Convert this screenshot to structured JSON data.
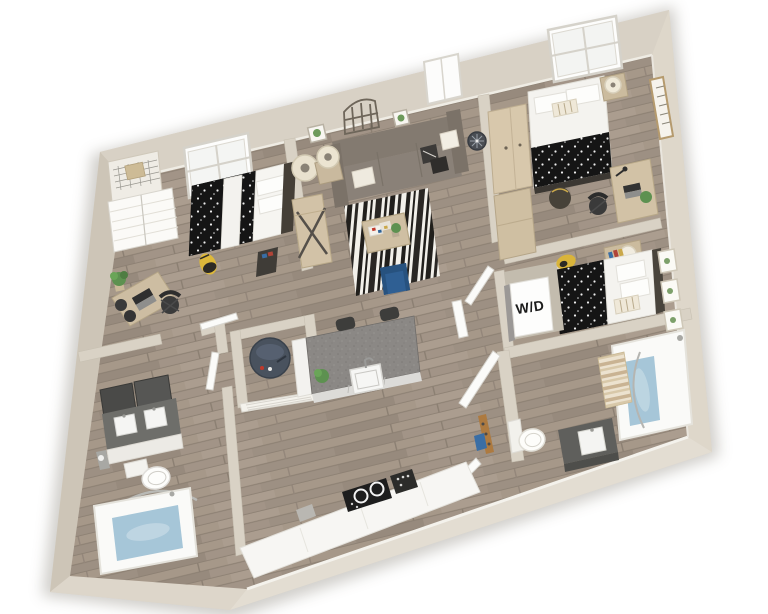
{
  "scene": {
    "kind": "3d-floor-plan-render",
    "view": "isometric top-down, plan rotated slightly counter-clockwise",
    "background": "#ffffff"
  },
  "labels": {
    "washer_dryer": "W/D"
  },
  "colors": {
    "wall": "#d8d1c5",
    "wall_left": "#cdc5b7",
    "wall_right": "#ded7ca",
    "wall_bottom_right": "#e3ddd2",
    "wall_bottom_left": "#ddd6ca",
    "floor_wood": "#a29487",
    "rug_base": "#f2f0ea",
    "rug_stripe": "#211f1c",
    "accent_chair": "#2f5f93",
    "tub_water": "#a6c6d8",
    "duvet_dots": "#151515",
    "sofa": "#8a8178",
    "island_top": "#8b8885",
    "vanity_dark": "#5f5f5c",
    "water_heater": "#49525e",
    "wood_furniture": "#d2c2a6",
    "plant": "#5d9150",
    "backpack": "#ddb83a",
    "counter_white": "#f7f6f3"
  },
  "rooms": [
    {
      "name": "Bedroom 1",
      "position": "top-left",
      "furniture": [
        "closet-shelf",
        "closet-door",
        "skylight-window",
        "polka-dot-bed",
        "nightstand",
        "desk",
        "office-chair",
        "backpack",
        "plant"
      ]
    },
    {
      "name": "Living Room",
      "position": "top-center",
      "furniture": [
        "sofa",
        "table-lamps",
        "side-table",
        "console-table",
        "striped-rug",
        "coffee-table",
        "accent-chair",
        "wall-clock",
        "arch-wall-decor",
        "framed-plants",
        "window"
      ]
    },
    {
      "name": "Bedroom 2",
      "position": "top-right",
      "furniture": [
        "skylight-window",
        "bed",
        "nightstand",
        "lamp",
        "wardrobe",
        "desk",
        "office-chair",
        "vertical-wall-sign",
        "backpack"
      ]
    },
    {
      "name": "Sleeping Nook",
      "position": "right-middle",
      "furniture": [
        "polka-dot-bed",
        "nightstand",
        "lamp",
        "botanical-prints",
        "backpack"
      ]
    },
    {
      "name": "Laundry Closet",
      "position": "center-right",
      "furniture": [
        "washer-dryer-unit"
      ]
    },
    {
      "name": "Bathroom 2",
      "position": "right-bottom",
      "furniture": [
        "bathtub",
        "shower-curtain",
        "vanity",
        "toilet",
        "door",
        "coat-rack"
      ]
    },
    {
      "name": "Utility Closet",
      "position": "center",
      "furniture": [
        "water-heater",
        "louvered-door"
      ]
    },
    {
      "name": "Kitchen",
      "position": "bottom-center",
      "furniture": [
        "island",
        "island-sink",
        "bar-stools",
        "counter",
        "cooktop",
        "range"
      ]
    },
    {
      "name": "Bathroom 1",
      "position": "bottom-left",
      "furniture": [
        "double-vanity",
        "mirrors",
        "toilet",
        "bathtub",
        "shower-rod",
        "door"
      ]
    }
  ]
}
